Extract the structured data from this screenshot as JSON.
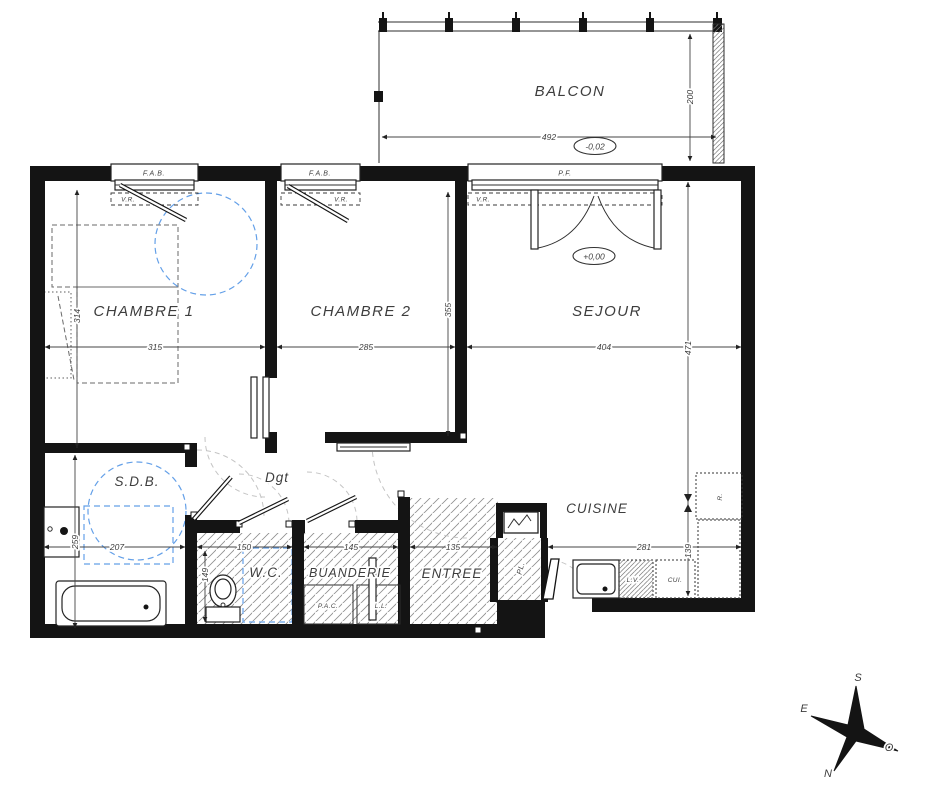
{
  "plan": {
    "balcon": {
      "label": "BALCON",
      "width": "492",
      "depth": "200",
      "level": "-0,02",
      "window": "P.F."
    },
    "chambre1": {
      "label": "CHAMBRE 1",
      "width": "315",
      "depth": "314",
      "window": "F.A.B.",
      "shutter": "V.R."
    },
    "chambre2": {
      "label": "CHAMBRE 2",
      "width": "285",
      "depth": "355",
      "window": "F.A.B.",
      "shutter": "V.R."
    },
    "sejour": {
      "label": "SEJOUR",
      "width": "404",
      "depth": "471",
      "level": "+0,00",
      "shutter": "V.R."
    },
    "sdb": {
      "label": "S.D.B.",
      "width": "207",
      "depth": "259"
    },
    "dgt": {
      "label": "Dgt"
    },
    "wc": {
      "label": "W.C.",
      "width": "150",
      "depth": "149"
    },
    "buanderie": {
      "label": "BUANDERIE",
      "width": "145",
      "pac": "P.A.C.",
      "ll": "L.L."
    },
    "entree": {
      "label": "ENTREE",
      "width": "135"
    },
    "cuisine": {
      "label": "CUISINE",
      "width": "281",
      "depth": "139",
      "lv": "L.V.",
      "cui": "CUI.",
      "fridge": "R.",
      "closet": "PL."
    },
    "compass": {
      "n": "N",
      "s": "S",
      "e": "E",
      "o": "O"
    }
  }
}
